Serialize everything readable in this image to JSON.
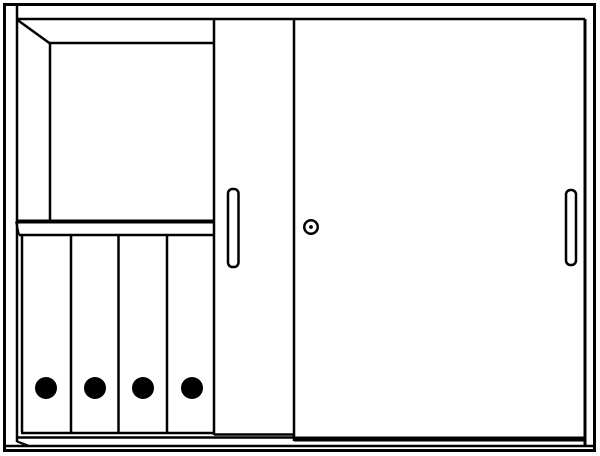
{
  "figure": {
    "type": "technical-line-drawing",
    "subject": "sliding-door cabinet, left door open showing shelf compartment and four ring binders",
    "background_color": "#ffffff",
    "line_color": "#000000",
    "canvas": {
      "width": 600,
      "height": 456
    }
  },
  "cabinet": {
    "door_count": 2,
    "door_style": "sliding",
    "open_compartment": {
      "shelf_count": 1,
      "binder_count": 4
    },
    "hardware": [
      "left-door-handle",
      "right-door-handle",
      "lock-cylinder"
    ]
  },
  "shapes": [
    {
      "type": "rect",
      "name": "cabinet-outer-frame",
      "x": 4.5,
      "y": 4.5,
      "w": 590,
      "h": 446,
      "sw": 3
    },
    {
      "type": "line",
      "name": "frame-inner-left-edge",
      "x1": 17,
      "y1": 6,
      "x2": 17,
      "y2": 442,
      "sw": 2.5
    },
    {
      "type": "line",
      "name": "frame-inner-top-edge",
      "x1": 16,
      "y1": 19,
      "x2": 585,
      "y2": 19,
      "sw": 2.5
    },
    {
      "type": "line",
      "name": "frame-inner-right-edge",
      "x1": 585,
      "y1": 19,
      "x2": 585,
      "y2": 445,
      "sw": 3
    },
    {
      "type": "line",
      "name": "frame-inner-bottom-edge",
      "x1": 6,
      "y1": 446,
      "x2": 594,
      "y2": 446,
      "sw": 2.5
    },
    {
      "type": "line",
      "name": "perspective-corner-edge",
      "x1": 17.5,
      "y1": 20,
      "x2": 50,
      "y2": 43.5,
      "sw": 2.5
    },
    {
      "type": "line",
      "name": "compartment-back-left-edge",
      "x1": 50,
      "y1": 42,
      "x2": 50,
      "y2": 222,
      "sw": 2.5
    },
    {
      "type": "line",
      "name": "compartment-back-top-edge",
      "x1": 49,
      "y1": 43,
      "x2": 214,
      "y2": 43,
      "sw": 2.5
    },
    {
      "type": "line",
      "name": "shelf-top-edge",
      "x1": 16,
      "y1": 221.5,
      "x2": 214,
      "y2": 221.5,
      "sw": 4
    },
    {
      "type": "line",
      "name": "shelf-bottom-edge",
      "x1": 19,
      "y1": 235,
      "x2": 214,
      "y2": 235,
      "sw": 2.5
    },
    {
      "type": "line",
      "name": "shelf-left-end-edge",
      "x1": 16,
      "y1": 221.5,
      "x2": 19,
      "y2": 235,
      "sw": 2
    },
    {
      "type": "line",
      "name": "binder-1-spine-edge",
      "x1": 22,
      "y1": 236,
      "x2": 22,
      "y2": 432,
      "sw": 2.5
    },
    {
      "type": "line",
      "name": "binder-2-spine-edge",
      "x1": 71,
      "y1": 236,
      "x2": 71,
      "y2": 432,
      "sw": 2.5
    },
    {
      "type": "line",
      "name": "binder-3-spine-edge",
      "x1": 118.5,
      "y1": 236,
      "x2": 118.5,
      "y2": 432,
      "sw": 2.5
    },
    {
      "type": "line",
      "name": "binder-4-spine-edge",
      "x1": 167,
      "y1": 236,
      "x2": 167,
      "y2": 432,
      "sw": 2.5
    },
    {
      "type": "line",
      "name": "binders-bottom-edge",
      "x1": 21,
      "y1": 433,
      "x2": 214,
      "y2": 433,
      "sw": 2.5
    },
    {
      "type": "circle",
      "name": "binder-1-finger-hole",
      "cx": 46,
      "cy": 388,
      "r": 11,
      "filled": true
    },
    {
      "type": "circle",
      "name": "binder-2-finger-hole",
      "cx": 95,
      "cy": 388,
      "r": 11,
      "filled": true
    },
    {
      "type": "circle",
      "name": "binder-3-finger-hole",
      "cx": 143,
      "cy": 388,
      "r": 11,
      "filled": true
    },
    {
      "type": "circle",
      "name": "binder-4-finger-hole",
      "cx": 192,
      "cy": 388,
      "r": 11,
      "filled": true
    },
    {
      "type": "line",
      "name": "left-door-leading-edge",
      "x1": 214,
      "y1": 19,
      "x2": 214,
      "y2": 435,
      "sw": 2.5
    },
    {
      "type": "line",
      "name": "left-door-bottom-edge",
      "x1": 214,
      "y1": 434.5,
      "x2": 294,
      "y2": 434.5,
      "sw": 2.5
    },
    {
      "type": "line",
      "name": "cabinet-floor-front-edge",
      "x1": 17,
      "y1": 437.5,
      "x2": 294,
      "y2": 437.5,
      "sw": 2.5
    },
    {
      "type": "line",
      "name": "cabinet-floor-left-bevel",
      "x1": 17,
      "y1": 441.5,
      "x2": 28,
      "y2": 445.5,
      "sw": 2
    },
    {
      "type": "rect",
      "name": "left-door-handle",
      "x": 228,
      "y": 189,
      "w": 10.5,
      "h": 78,
      "rx": 4.5,
      "sw": 2.5
    },
    {
      "type": "line",
      "name": "right-door-leading-edge",
      "x1": 294,
      "y1": 19,
      "x2": 294,
      "y2": 441,
      "sw": 2.5
    },
    {
      "type": "line",
      "name": "right-door-bottom-rail",
      "x1": 294,
      "y1": 439,
      "x2": 585,
      "y2": 439,
      "sw": 5
    },
    {
      "type": "circle",
      "name": "lock-cylinder",
      "cx": 311,
      "cy": 227,
      "r": 6.75,
      "sw": 2.5,
      "filled": false
    },
    {
      "type": "circle",
      "name": "lock-keyhole-dot",
      "cx": 311,
      "cy": 227,
      "r": 1.9,
      "filled": true
    },
    {
      "type": "rect",
      "name": "right-door-handle",
      "x": 566,
      "y": 190,
      "w": 10,
      "h": 75,
      "rx": 4.5,
      "sw": 2.5
    }
  ]
}
